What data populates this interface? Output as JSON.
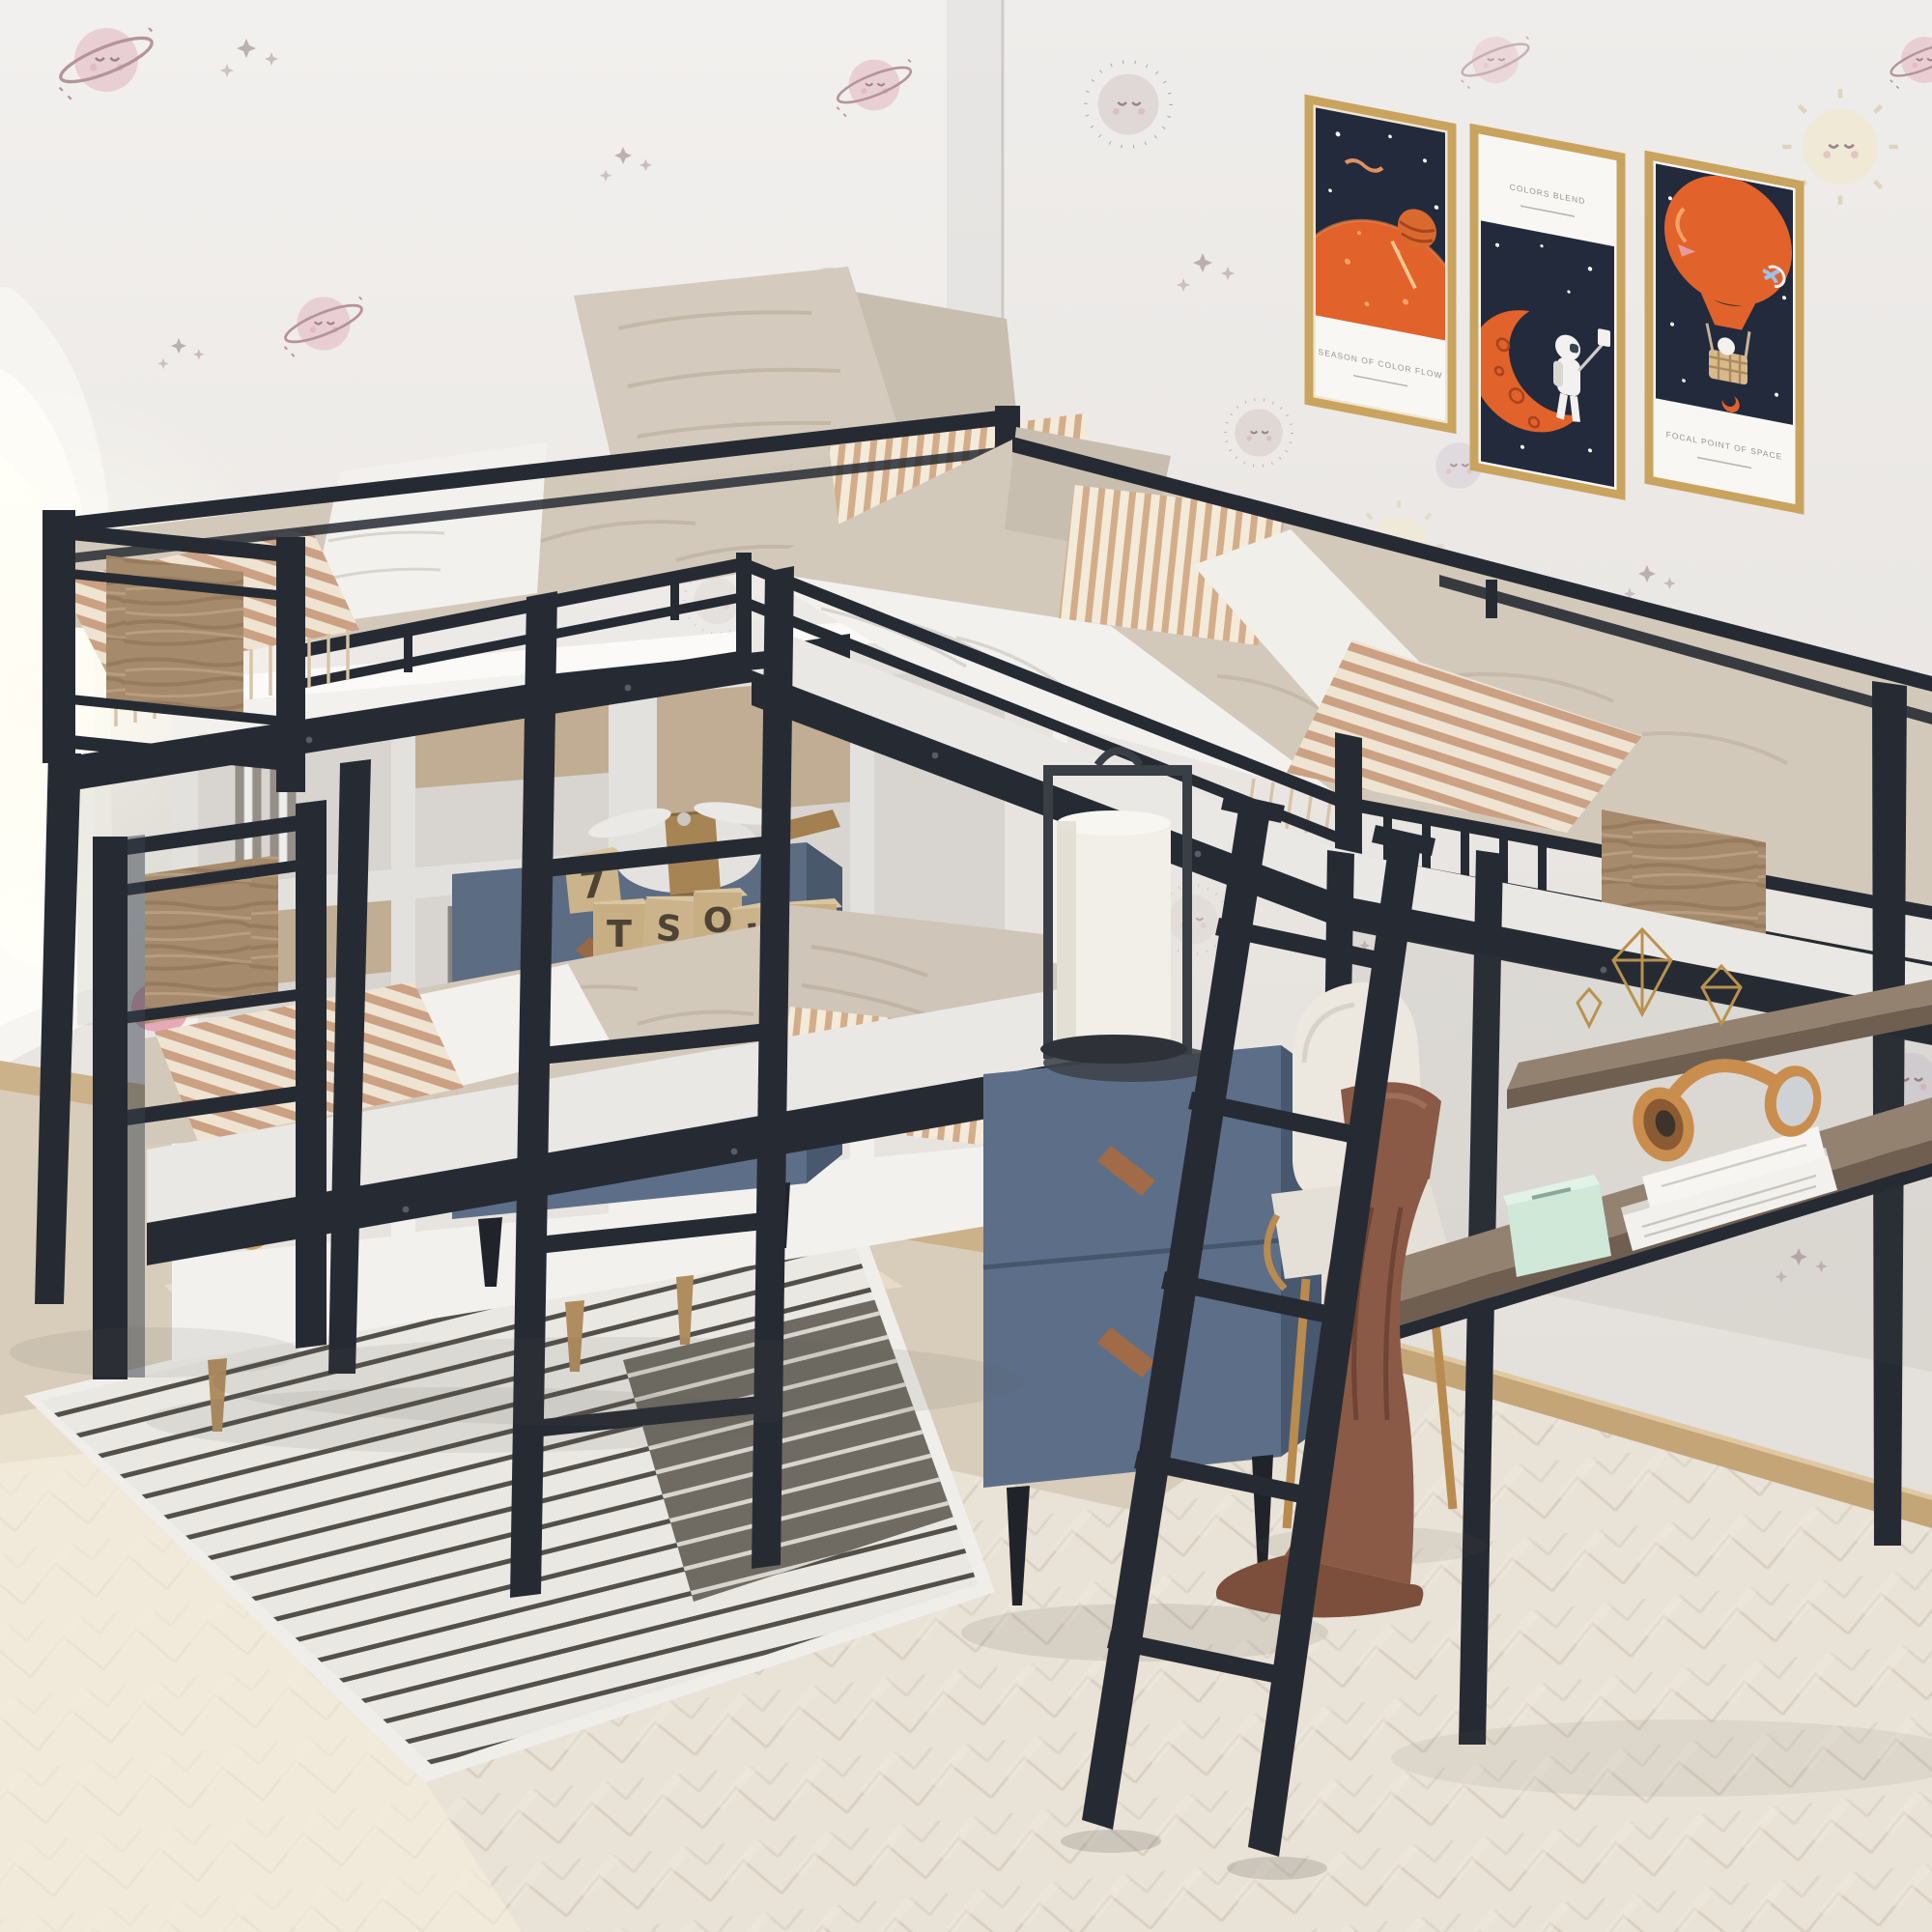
{
  "scene": {
    "kind": "product-photograph",
    "description": "Kids bedroom with an L-shaped triple bunk bed: twin-over-twin bunk at left joined to a twin loft bed with desk and shelves at right, black metal frame with rustic wood accent panels",
    "room": {
      "wallpaper": "off-white wallpaper with pastel cartoon ringed planets, sleepy moons, suns and tiny stars",
      "window": "white arched doorway with bright daylight on far left",
      "floor": "pale herringbone wood floor with beige area near the walls",
      "rug": "striped cream rug with charcoal stripe block under the lower bunk"
    }
  },
  "posters": [
    {
      "name": "orange-planet-poster",
      "art": "large orange planet with shooting star on navy sky",
      "caption": "SEASON OF COLOR FLOW",
      "frame_color": "#c9a45f"
    },
    {
      "name": "astronaut-moon-poster",
      "art": "astronaut taking a selfie on an orange crescent moon",
      "caption": "COLORS BLEND",
      "frame_color": "#c9a45f"
    },
    {
      "name": "hot-air-balloon-poster",
      "art": "orange hot-air balloon with astronaut basket and rocket",
      "caption": "FOCAL POINT OF SPACE",
      "frame_color": "#c9a45f"
    }
  ],
  "toy_blocks": {
    "letters": [
      "7",
      "T",
      "S",
      "O",
      "K",
      "E"
    ]
  },
  "furniture": [
    {
      "name": "l-shaped-triple-bunk-bed",
      "frame_color": "#262b33",
      "accent": "rustic wood panels"
    },
    {
      "name": "white-cube-bookcase",
      "contents": "books, vases, plant, bowls, boxes"
    },
    {
      "name": "blue-nightstand-left",
      "drawers": 2,
      "items_on_top": "wooden letter blocks and white toy plane"
    },
    {
      "name": "blue-nightstand-right",
      "drawers": 2,
      "items_on_top": "lantern lamp on round tray"
    },
    {
      "name": "loft-desk",
      "items_on_top": "mint radio, two white books, tan headphones, brown towel"
    },
    {
      "name": "wall-shelf",
      "items_on_top": "gold wire geometric ornaments"
    },
    {
      "name": "desk-chair",
      "color": "cream boucle with gold legs"
    },
    {
      "name": "vertical-ladder"
    },
    {
      "name": "slanted-ladder"
    },
    {
      "name": "strawberry-plush-toy"
    }
  ],
  "palette": {
    "metal_frame": "#262b33",
    "wood_accent": "#a58a6b",
    "wall": "#edeae7",
    "bedding_beige": "#d3c9bb",
    "bedding_stripe": "#cba183",
    "sheet_white": "#f3f1ed",
    "nightstand_blue": "#5d6f88",
    "handle_wood": "#a06b46",
    "poster_navy": "#222a3c",
    "poster_orange": "#e2622b",
    "frame_gold": "#c9a45f",
    "rug_light": "#eae8e3",
    "rug_dark": "#6f6b63",
    "floor": "#e9e2d6",
    "towel_brown": "#8a5a46",
    "headphones_tan": "#c98d4e",
    "radio_mint": "#cfe8d8",
    "chair_gold_legs": "#b98b4e"
  }
}
